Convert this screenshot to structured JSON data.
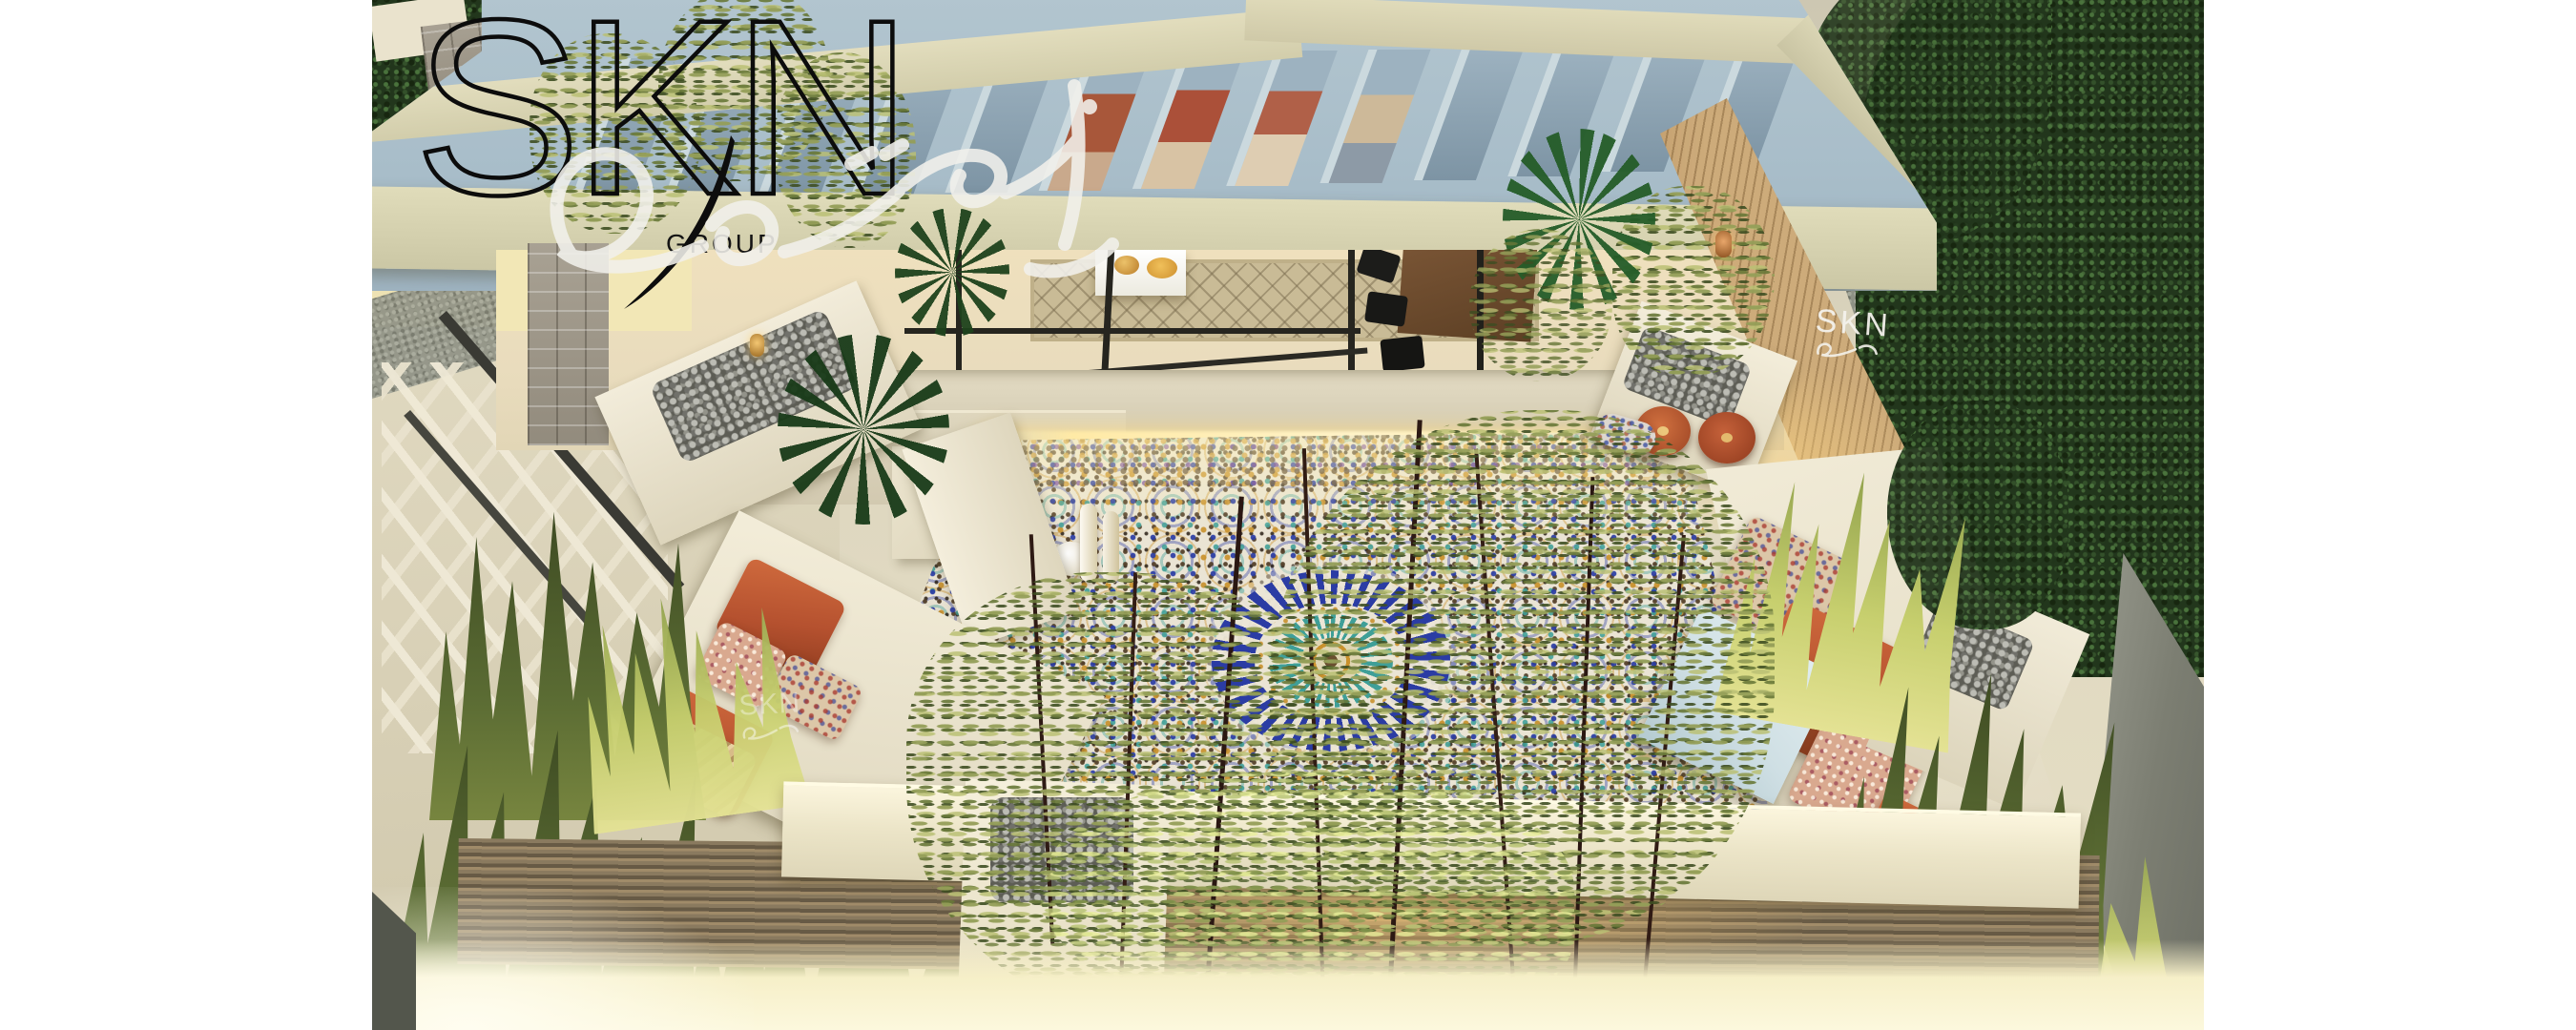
{
  "scene": {
    "type": "architectural-3d-render",
    "subject": "aerial-view-moroccan-rooftop-courtyard-at-dusk"
  },
  "branding": {
    "logo_text": "SKN",
    "logo_subtext": "GROUP",
    "signature_icon": "calligraphy-signature-icon",
    "wall_logo_text": "SKN",
    "watermark_text": "SKN"
  },
  "palette": {
    "canvas_margin": "#ffffff",
    "pergola_top": "#a8bdc9",
    "pergola_opening": "#7d94a4",
    "pergola_fascia": "#d8d4b2",
    "wall_cream": "#e6dfca",
    "travertine": "#ddd5bd",
    "interior_warm": "#e9dcbd",
    "mosaic_ground": "#eae4d4",
    "mosaic_blue": "#2b3ca4",
    "mosaic_teal": "#3f9f98",
    "mosaic_amber": "#c9912c",
    "mosaic_brown": "#54402a",
    "cushion_terracotta": "#b5512f",
    "table_blue": "#cfdfe4",
    "wood_slat": "#c4a271",
    "foliage_dark": "#22361c",
    "foliage_olive": "#97a05a",
    "grass_lit": "#c7cf6e",
    "led_glow": "#ffeaa6",
    "bottom_glow": "#fcf8dd",
    "gravel": "#8e9185",
    "stone_gray": "#a7a092"
  },
  "scene_elements": [
    "slatted-pergola-roof",
    "indoor-lounge",
    "bar-counter",
    "bar-stools",
    "berber-rug",
    "coffee-table",
    "zellige-mosaic-courtyard",
    "central-blue-medallion",
    "carved-white-vases",
    "led-strip-lighting",
    "left-bench-terracotta-cushions",
    "right-bench-terracotta-cushions",
    "round-poufs",
    "blue-side-table",
    "white-planters-with-rocks",
    "olive-trees",
    "fan-palms",
    "bamboo-screen",
    "ornamental-grasses",
    "wood-slat-wall",
    "lattice-trellis",
    "stone-pillar",
    "hanging-lanterns",
    "gravel-path",
    "street-trees"
  ]
}
